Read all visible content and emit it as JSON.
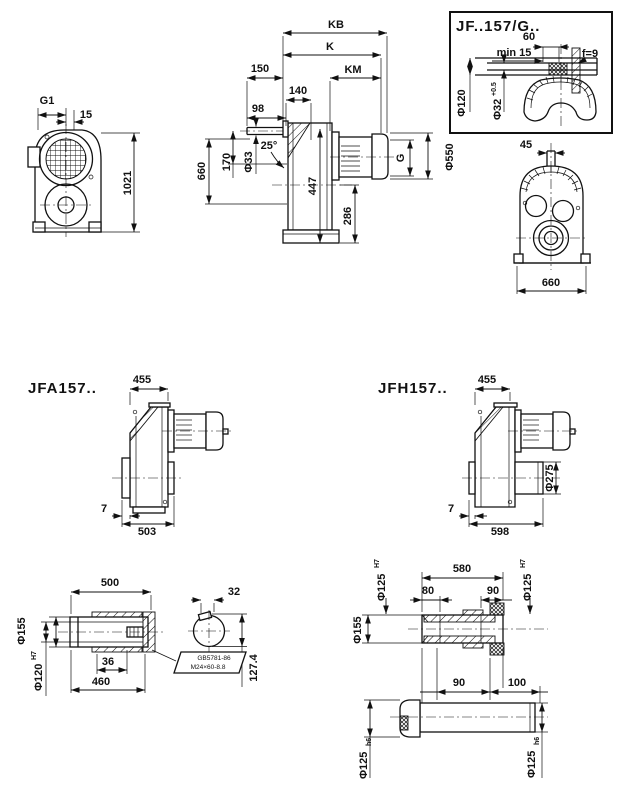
{
  "front_view": {
    "g1": "G1",
    "d15": "15",
    "d1021": "1021"
  },
  "side_view": {
    "kb": "KB",
    "k": "K",
    "km": "KM",
    "d150": "150",
    "d140": "140",
    "d98": "98",
    "d660": "660",
    "d170": "170",
    "phi33": "Φ33",
    "a25": "25°",
    "d447": "447",
    "d286": "286",
    "g": "G",
    "phi550": "Φ550"
  },
  "detail_box": {
    "title": "JF..157/G..",
    "d60": "60",
    "min15": "min 15",
    "f9": "f=9",
    "phi120": "Φ120",
    "phi32": "Φ32",
    "phi32_tol": "+0.5"
  },
  "rear_view": {
    "d45": "45",
    "d660": "660"
  },
  "jfa": {
    "title": "JFA157..",
    "d455": "455",
    "d7": "7",
    "d503": "503"
  },
  "jfh": {
    "title": "JFH157..",
    "d455": "455",
    "phi275": "Φ275",
    "d7": "7",
    "d598": "598"
  },
  "solid_shaft": {
    "d500": "500",
    "phi155": "Φ155",
    "phi120": "Φ120",
    "phi120_tol": "H7",
    "d36": "36",
    "d460": "460",
    "d32": "32",
    "d127": "127.4",
    "callout1": "GB5781-86",
    "callout2": "M24×60-8.8"
  },
  "hollow_shaft": {
    "d580": "580",
    "d80": "80",
    "d90a": "90",
    "phi125a": "Φ125",
    "phi125a_tol": "H7",
    "phi125b": "Φ125",
    "phi125b_tol": "H7",
    "phi155": "Φ155",
    "d90b": "90",
    "d100": "100",
    "phi125c": "Φ125",
    "phi125c_tol": "h6",
    "phi125d": "Φ125",
    "phi125d_tol": "h6"
  }
}
